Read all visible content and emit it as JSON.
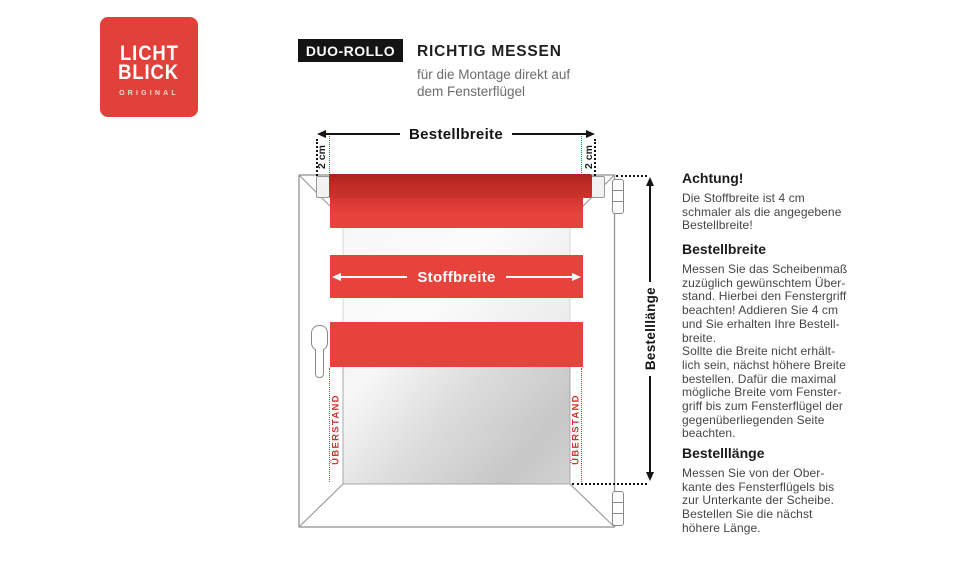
{
  "logo": {
    "line1": "LICHT",
    "line2": "BLICK",
    "sub": "ORIGINAL",
    "bg_color": "#e2403b"
  },
  "header": {
    "badge": "DUO-ROLLO",
    "title": "RICHTIG MESSEN",
    "subtitle": "für die Montage direkt auf\ndem Fensterflügel"
  },
  "diagram": {
    "bestellbreite_label": "Bestellbreite",
    "stoffbreite_label": "Stoffbreite",
    "bestelllaenge_label": "Bestelllänge",
    "two_cm": "2 cm",
    "ueberstand": "ÜBERSTAND",
    "colors": {
      "fabric_red": "#e8423c",
      "roller_red": "#bf2a24",
      "dotted_red": "#cf3530",
      "line_black": "#141414",
      "frame_gray": "#9b9b9b"
    }
  },
  "sections": [
    {
      "heading": "Achtung!",
      "body": "Die Stoffbreite ist 4 cm\nschmaler als die angegebene\nBestellbreite!"
    },
    {
      "heading": "Bestellbreite",
      "body": "Messen Sie das Scheibenmaß\nzuzüglich gewünschtem Über-\nstand. Hierbei den Fenstergriff\nbeachten! Addieren Sie 4 cm\nund Sie erhalten Ihre Bestell-\nbreite.\nSollte die Breite nicht erhält-\nlich sein, nächst höhere Breite\nbestellen. Dafür die maximal\nmögliche Breite vom Fenster-\ngriff bis zum Fensterflügel der\ngegenüberliegenden Seite\nbeachten."
    },
    {
      "heading": "Bestelllänge",
      "body": "Messen Sie von der Ober-\nkante des Fensterflügels bis\nzur Unterkante der Scheibe.\nBestellen Sie die nächst\nhöhere Länge."
    }
  ]
}
